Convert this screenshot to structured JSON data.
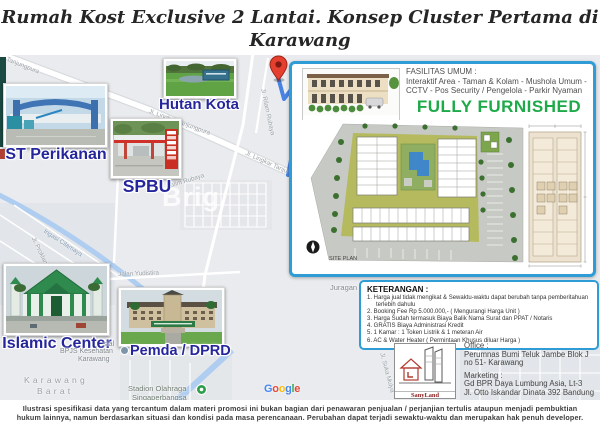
{
  "header": {
    "line1": "Rumah Kost Exclusive 2 Lantai. Konsep Cluster Pertama di Karawang",
    "line2": "dengan kemudahan Termin Pembayaran. Lebih Murah dari KPR Bank"
  },
  "map": {
    "poi": {
      "hutan_kota": "Hutan Kota",
      "st_perikanan": "ST Perikanan",
      "spbu": "SPBU",
      "islamic_center": "Islamic Center",
      "pemda_dprd": "Pemda / DPRD"
    },
    "roads": {
      "tanjungpura_top": "Tanjungpura",
      "lingkar_1": "Jl. Lingkar Tanjungpura",
      "lingkar_2": "Jl. Lingkar Tanju",
      "kalim_rubaya": "Jl. Kalim Rubaya",
      "rilam_rubaya": "Jl. Rilam Rubaya",
      "yudistira": "Jalan Yudistira",
      "proklamasi": "Jl. Proklamasi",
      "irigasi": "Irigasi Cilamaya",
      "cibungur": "Jl. Cibungur",
      "suka_mulya": "Jl. Suka Mulya"
    },
    "places": {
      "sial": "sial",
      "bpjs_1": "BPJS Kesehatan",
      "bpjs_2": "Karawang",
      "kb_1": "Karawang",
      "kb_2": "Barat",
      "juragan": "Juragan",
      "stadion_1": "Stadion Olahraga",
      "stadion_2": "Singaperbangsa"
    },
    "watermark": "Brig",
    "google_letters": [
      "G",
      "o",
      "o",
      "g",
      "l",
      "e"
    ]
  },
  "panel": {
    "fasilitas_title": "FASILITAS UMUM :",
    "fasilitas_line1": "Interaktif Area - Taman & Kolam - Mushola Umum -",
    "fasilitas_line2": "CCTV - Pos Security / Pengelola - Parkir Nyaman",
    "fully_furnished": "FULLY FURNISHED",
    "site_plan_label": "SITE PLAN"
  },
  "keterangan": {
    "title": "KETERANGAN :",
    "items": [
      "1. Harga jual tidak mengikat & Sewaktu-waktu dapat berubah tanpa pemberitahuan terlebih dahulu",
      "2. Booking Fee Rp 5.000.000,- ( Mengurangi Harga Unit )",
      "3. Harga Sudah termasuk Biaya Balik Nama Surat dan PPAT / Notaris",
      "4. GRATIS Biaya Administrasi Kredit",
      "5. 1 Kamar : 1 Token Listrik & 1 meteran Air",
      "6. AC & Water Heater ( Permintaan Khusus diluar Harga )"
    ]
  },
  "office": {
    "office_title": "Office :",
    "address1": "Perumnas Bumi Teluk Jambe Blok J",
    "address2": "no 51- Karawang",
    "marketing_title": "Marketing :",
    "marketing1": "Gd BPR Daya Lumbung Asia, Lt-3",
    "marketing2": "Jl. Otto Iskandar Dinata 392 Bandung"
  },
  "logo": {
    "name": "SanyLand Development"
  },
  "disclaimer": {
    "line1": "Ilustrasi spesifikasi data yang tercantum dalam materi promosi ini bukan bagian dari penawaran penjualan / perjanjian tertulis ataupun menjadi pembuktian",
    "line2": "hukum lainnya, namun berdasarkan situasi dan kondisi pada masa perencanaan. Perubahan dapat terjadi sewaktu-waktu dan merupakan hak penuh developer."
  },
  "colors": {
    "accent_border_blue": "#2f9cd6",
    "label_blue": "#26269c",
    "furnished_green": "#1faa4a",
    "logo_maroon": "#8b2020",
    "pin_red": "#e5402f",
    "route_blue": "#3f7de0",
    "google": [
      "#4285F4",
      "#EA4335",
      "#FBBC05",
      "#4285F4",
      "#34A853",
      "#EA4335"
    ]
  }
}
